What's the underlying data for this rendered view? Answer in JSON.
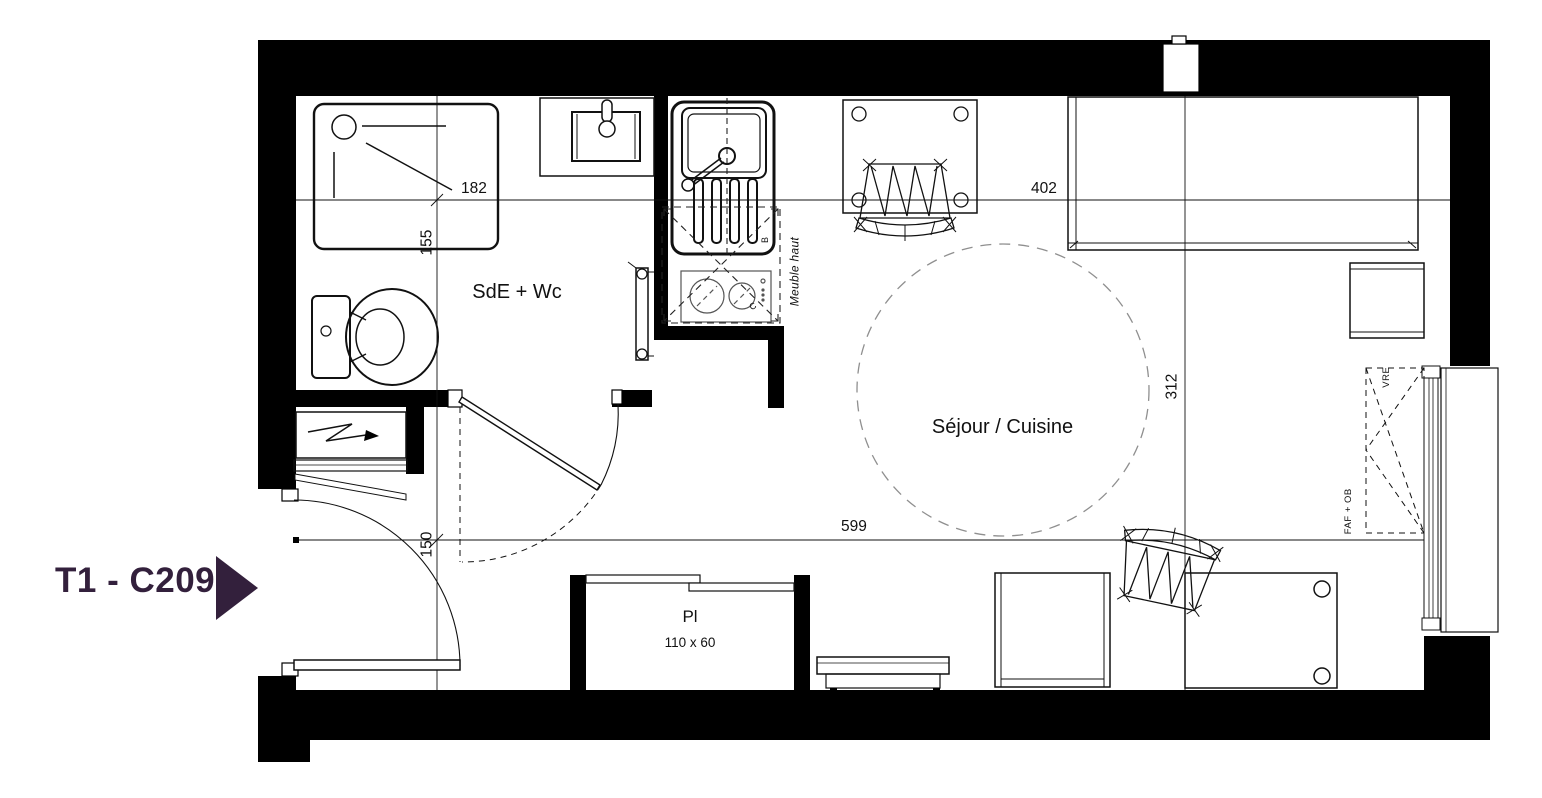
{
  "title_block": {
    "unit_label": "T1 - C209",
    "accent_color": "#33203c"
  },
  "rooms": {
    "bathroom_label": "SdE + Wc",
    "living_label": "Séjour / Cuisine",
    "closet_label": "Pl",
    "closet_size": "110 x 60"
  },
  "dimensions": {
    "bathroom_width": "182",
    "bathroom_depth": "155",
    "living_width": "402",
    "living_depth": "312",
    "apartment_length": "599",
    "entry_width": "150"
  },
  "annotations": {
    "upper_cabinet": "Meuble haut",
    "window_shutter": "VRE",
    "window_type": "FAF + OB",
    "sink_tag": "B",
    "hob_tag": "C"
  },
  "palette": {
    "wall_color": "#000000",
    "line_color": "#111111",
    "dash_color": "#8f8f8f"
  }
}
